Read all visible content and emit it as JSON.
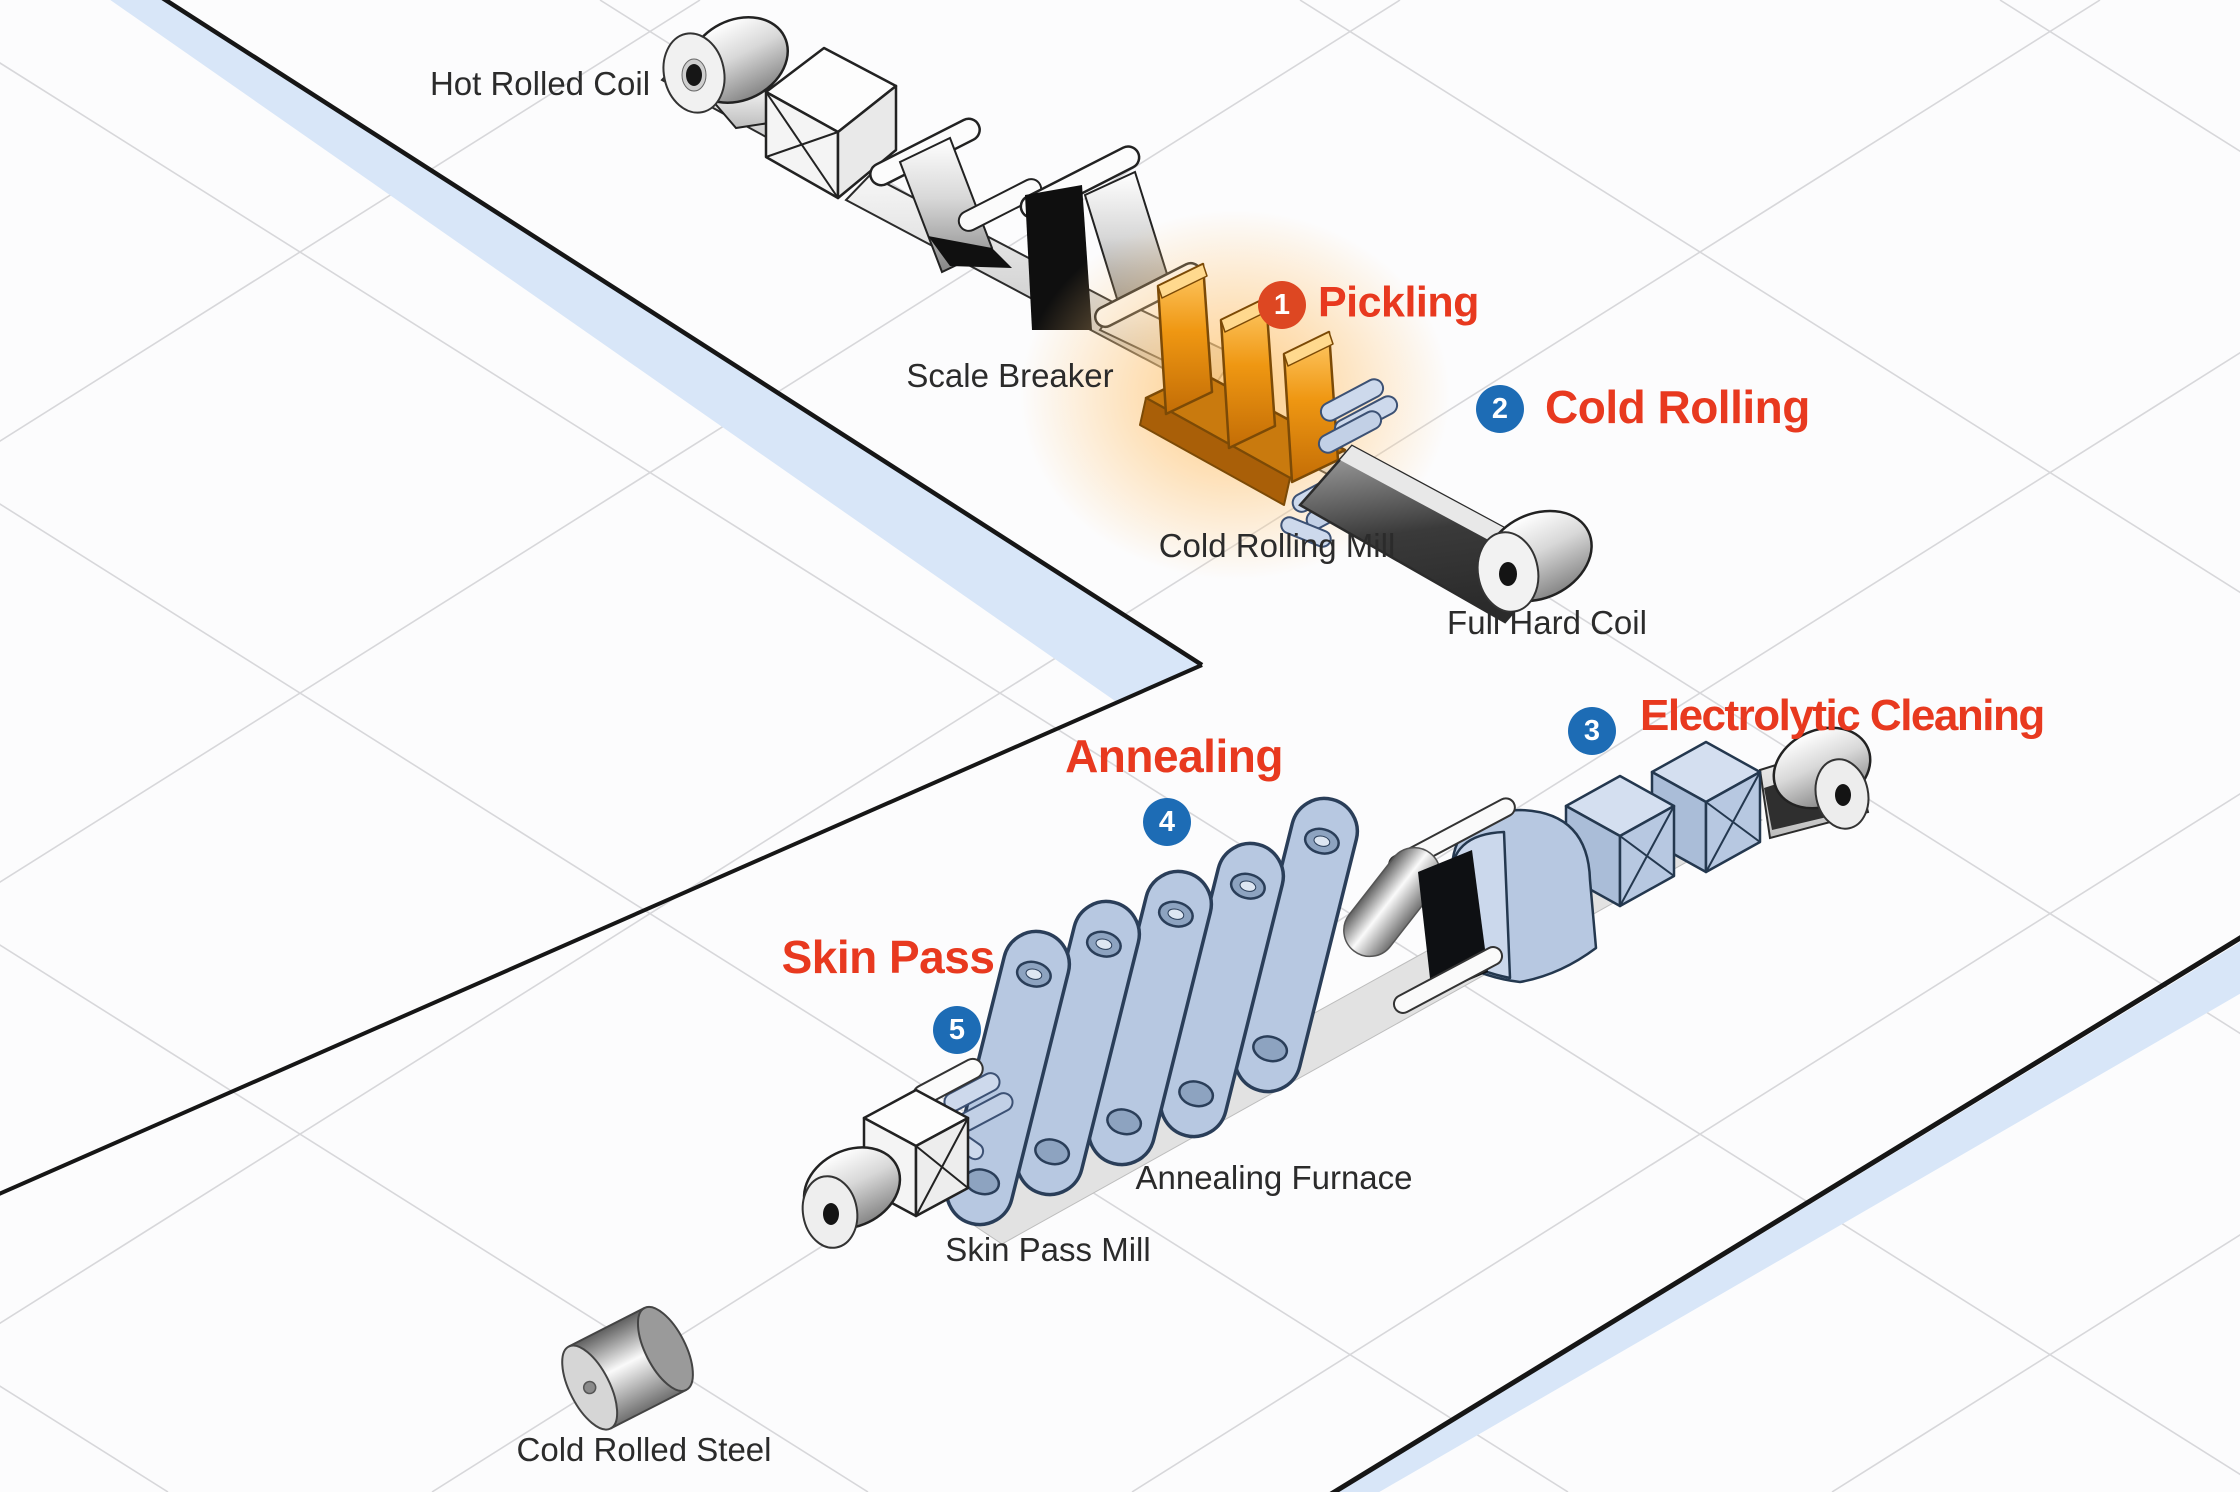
{
  "diagram": {
    "process_steps": [
      {
        "number": "1",
        "label": "Pickling"
      },
      {
        "number": "2",
        "label": "Cold Rolling"
      },
      {
        "number": "3",
        "label": "Electrolytic Cleaning"
      },
      {
        "number": "4",
        "label": "Annealing"
      },
      {
        "number": "5",
        "label": "Skin Pass"
      }
    ],
    "equipment_labels": [
      {
        "text": "Hot Rolled Coil"
      },
      {
        "text": "Scale Breaker"
      },
      {
        "text": "Cold Rolling Mill"
      },
      {
        "text": "Full Hard Coil"
      },
      {
        "text": "Annealing Furnace"
      },
      {
        "text": "Skin Pass Mill"
      },
      {
        "text": "Cold Rolled Steel"
      }
    ],
    "colors": {
      "step_label_red": "#e8391f",
      "badge_red": "#dd4722",
      "badge_blue": "#1d6cb5",
      "pickling_orange": "#f0960f",
      "machine_blue": "#b7c8e1",
      "platform_edge_blue": "#d8e6f8"
    }
  }
}
